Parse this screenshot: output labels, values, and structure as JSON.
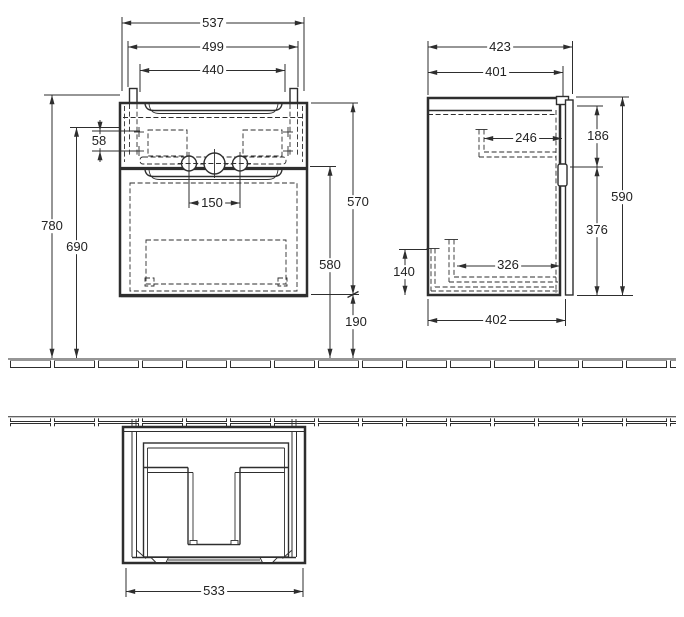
{
  "drawing": {
    "kind": "furniture installation dimension drawing",
    "line_color": "#2e2e2e",
    "views": {
      "front": {
        "dimensions": {
          "overall_width": "537",
          "rail_width": "499",
          "inner_width": "440",
          "bracket_hole_spacing": "58",
          "tap_hole_spacing": "150",
          "overall_height": "780",
          "mounting_height": "690",
          "cabinet_height": "570",
          "rim_to_floor": "580",
          "floor_clearance": "190"
        }
      },
      "side": {
        "dimensions": {
          "overall_depth": "423",
          "carcass_depth": "401",
          "upper_recess_depth": "246",
          "upper_section_height": "186",
          "side_height": "590",
          "lower_section_height": "376",
          "siphon_recess_height": "140",
          "siphon_recess_depth": "326",
          "bottom_depth": "402"
        }
      },
      "bottom": {
        "dimensions": {
          "overall_width": "533"
        }
      }
    }
  }
}
